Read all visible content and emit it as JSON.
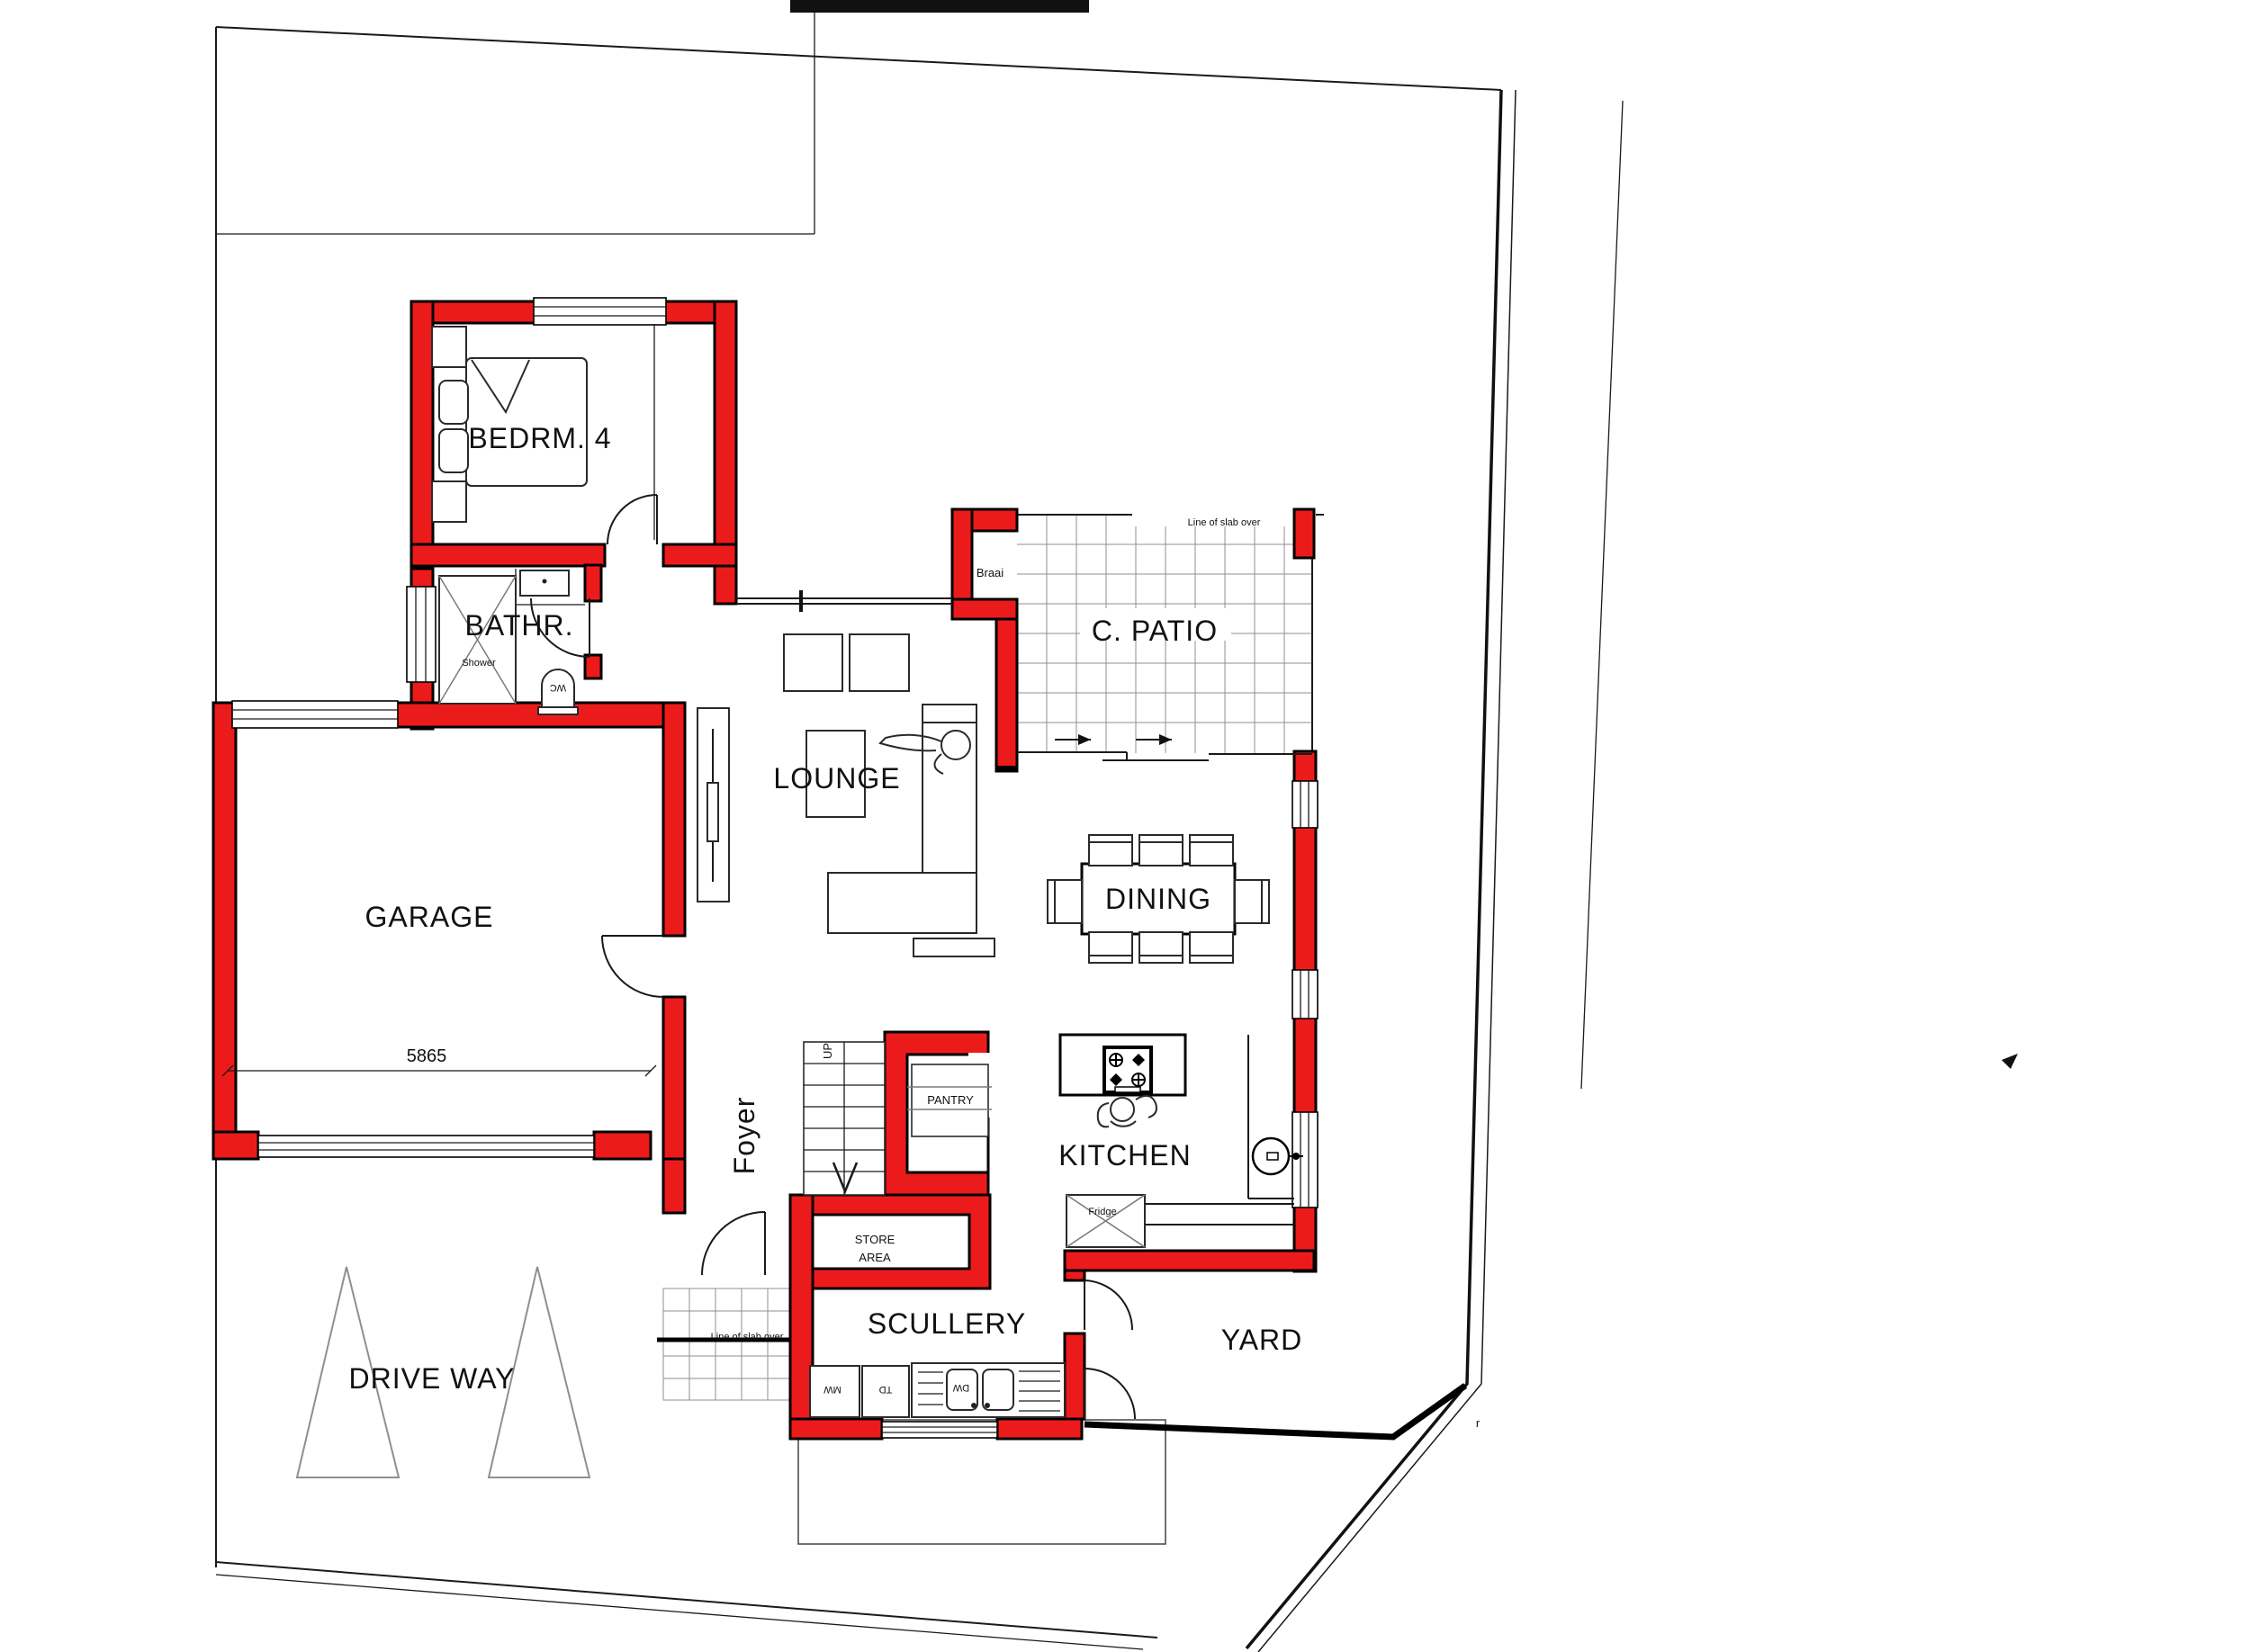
{
  "document": {
    "type": "architectural-floor-plan",
    "colors": {
      "wall_red": "#ec1b1b",
      "line": "#1a1a1a",
      "grid_gray": "#8f8f8f"
    }
  },
  "rooms": {
    "bedroom4": "BEDRM. 4",
    "bathroom": "BATHR.",
    "garage": "GARAGE",
    "foyer": "Foyer",
    "lounge": "LOUNGE",
    "patio": "C. PATIO",
    "dining": "DINING",
    "kitchen": "KITCHEN",
    "pantry": "PANTRY",
    "store_line1": "STORE",
    "store_line2": "AREA",
    "scullery": "SCULLERY",
    "yard": "YARD",
    "driveway": "DRIVE WAY"
  },
  "fixtures": {
    "shower": "Shower",
    "wc": "WC",
    "braai": "Braai",
    "fridge": "Fridge",
    "microwave": "MW",
    "tumble_dryer": "TD",
    "dishwasher": "DW",
    "stairs_up": "UP"
  },
  "annotations": {
    "slab_patio": "Line of slab over",
    "slab_porch": "Line of slab over",
    "garage_dim": "5865",
    "corner_mark": "r"
  }
}
